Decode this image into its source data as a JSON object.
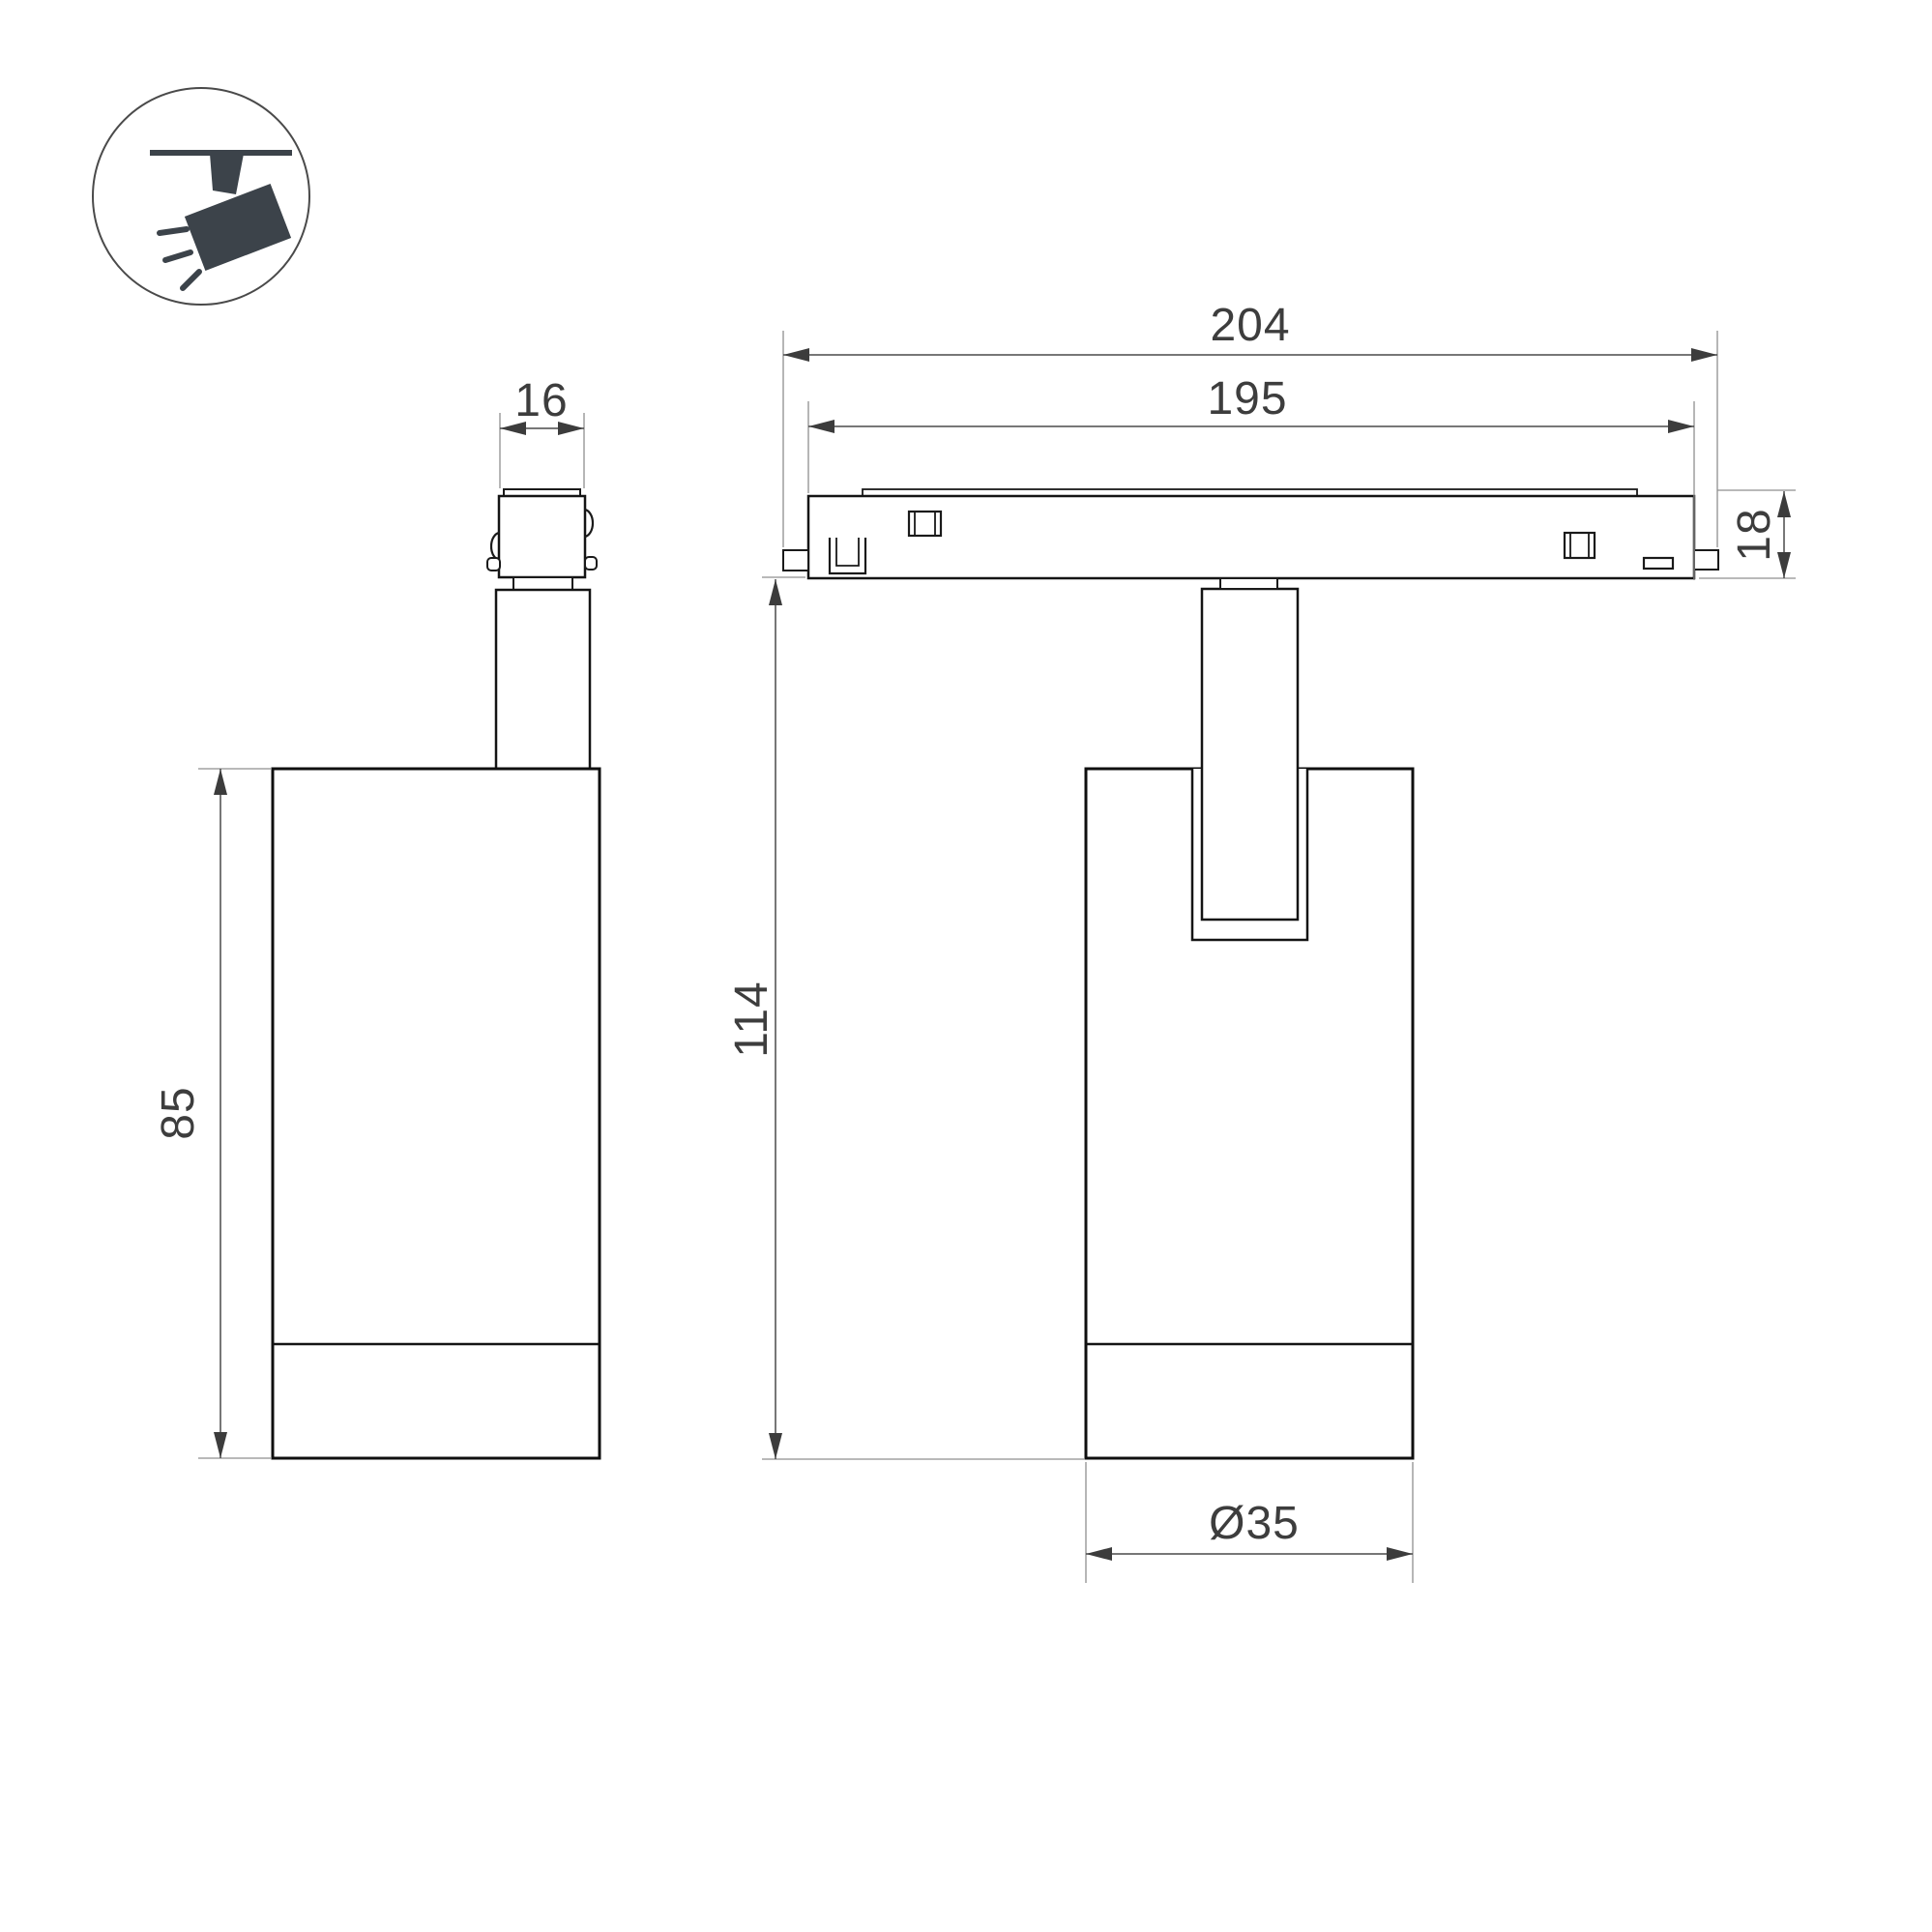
{
  "drawing": {
    "type": "technical dimension drawing",
    "subject": "magnetic track spotlight, two orthographic views with ceiling-mount icon",
    "background_color": "#ffffff",
    "outline_color": "#141414",
    "dimension_line_color": "#4a4a4a",
    "extension_line_color": "#8f8f8f",
    "text_color": "#3d3d3d",
    "icon_color": "#3c434a"
  },
  "dimensions": {
    "track_overall_length": "204",
    "track_mount_length": "195",
    "track_height": "18",
    "fixture_total_height": "114",
    "body_diameter": "Ø35",
    "adapter_width": "16",
    "body_height": "85"
  }
}
